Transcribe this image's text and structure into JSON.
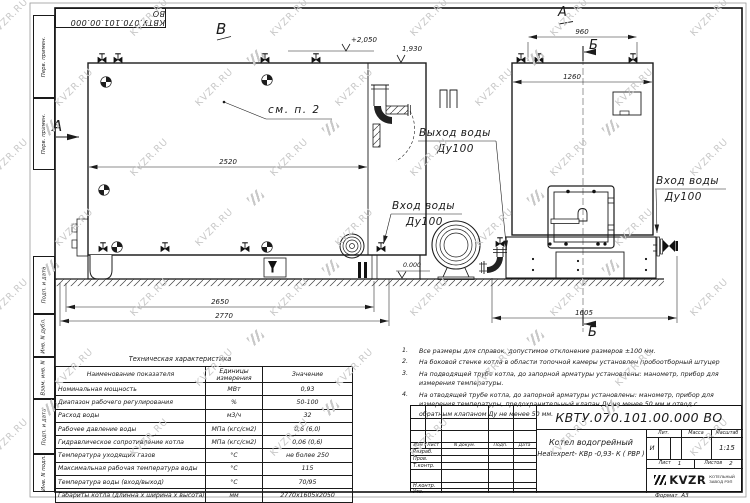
{
  "watermark": {
    "text": "KVZR.RU"
  },
  "margin": {
    "labels": [
      "Перв. примен.",
      "Перв. примен.",
      "Подп. и дата",
      "Инв. N дубл.",
      "Взам. инв. N",
      "Подп. и дата",
      "Инв. N подл."
    ]
  },
  "drawing": {
    "view_labels": {
      "a_left": "А",
      "v_top": "В",
      "a_right": "А",
      "b_top": "Б",
      "b_bottom": "Б"
    },
    "annotations": {
      "see_note": "см. п. 2",
      "outlet_title": "Выход воды",
      "outlet_dn": "Ду100",
      "inlet_title": "Вход воды",
      "inlet_dn": "Ду100",
      "inlet2_title": "Вход воды",
      "inlet2_dn": "Ду100"
    },
    "levels": {
      "top": "+2,050",
      "flue": "1,930",
      "ground": "0.000"
    },
    "dims": {
      "d2520": "2520",
      "d2650": "2650",
      "d2770": "2770",
      "d960": "960",
      "d1260": "1260",
      "d1605": "1605"
    }
  },
  "notes": {
    "items": [
      {
        "num": "1.",
        "text": "Все размеры для справок, допустимое отклонение размеров ±100 мм."
      },
      {
        "num": "2.",
        "text": "На боковой стенке котла в области топочной камеры установлен пробоотборный штуцер"
      },
      {
        "num": "3.",
        "text": "На подводящей трубе котла, до запорной арматуры установлены: манометр, прибор для измерения температуры."
      },
      {
        "num": "4.",
        "text": "На отводящей трубе котла, до запорной арматуры установлены: манометр, прибор для измерения температуры, предохранительный клапан Ду не менее 50 мм и отвод с обратным клапаном Ду не менее 50 мм."
      }
    ]
  },
  "tech_table": {
    "title": "Техническая характеристика",
    "headers": [
      "Наименование показателя",
      "Единицы измерения",
      "Значение"
    ],
    "rows": [
      {
        "name": "Номинальная мощность",
        "unit": "МВт",
        "value": "0,93"
      },
      {
        "name": "Диапазон рабочего регулирования",
        "unit": "%",
        "value": "50-100"
      },
      {
        "name": "Расход воды",
        "unit": "м3/ч",
        "value": "32"
      },
      {
        "name": "Рабочее давление воды",
        "unit": "МПа (кгс/см2)",
        "value": "0,6 (6,0)"
      },
      {
        "name": "Гидравлическое сопротивление котла",
        "unit": "МПа (кгс/см2)",
        "value": "0,06 (0,6)"
      },
      {
        "name": "Температура уходящих газов",
        "unit": "°С",
        "value": "не более 250"
      },
      {
        "name": "Максимальная рабочая температура воды",
        "unit": "°С",
        "value": "115"
      },
      {
        "name": "Температура воды (вход/выход)",
        "unit": "°С",
        "value": "70/95"
      },
      {
        "name": "Габариты котла (длинна х ширина х высота)",
        "unit": "мм",
        "value": "2770х1605х2050"
      }
    ]
  },
  "title_block": {
    "doc_number": "КВТУ.070.101.00.000  ВО",
    "product_line1": "Котел водогрейный",
    "product_line2": "Heatexpert- КВр -0,93- К ( РВР )",
    "col_izm": "Изм",
    "col_list": "Лист",
    "col_ndoc": "N докум.",
    "col_podp": "Подп.",
    "col_data": "Дата",
    "row_razrab": "Разраб.",
    "row_prov": "Пров.",
    "row_tkontr": "Т.контр.",
    "row_nkontr": "Н.контр.",
    "row_utv": "Утв.",
    "lit_label": "Лит.",
    "lit_value": "И",
    "massa_label": "Масса",
    "masshtab_label": "Масштаб",
    "masshtab_value": "1:15",
    "sheet_label": "Лист",
    "sheet_value": "1",
    "sheets_label": "Листов",
    "sheets_value": "2",
    "logo_text": "KVZR",
    "logo_sub1": "КОТЕЛЬНЫЙ",
    "logo_sub2": "ЗАВОД РЭП",
    "format_label": "Формат",
    "format_value": "А3"
  }
}
